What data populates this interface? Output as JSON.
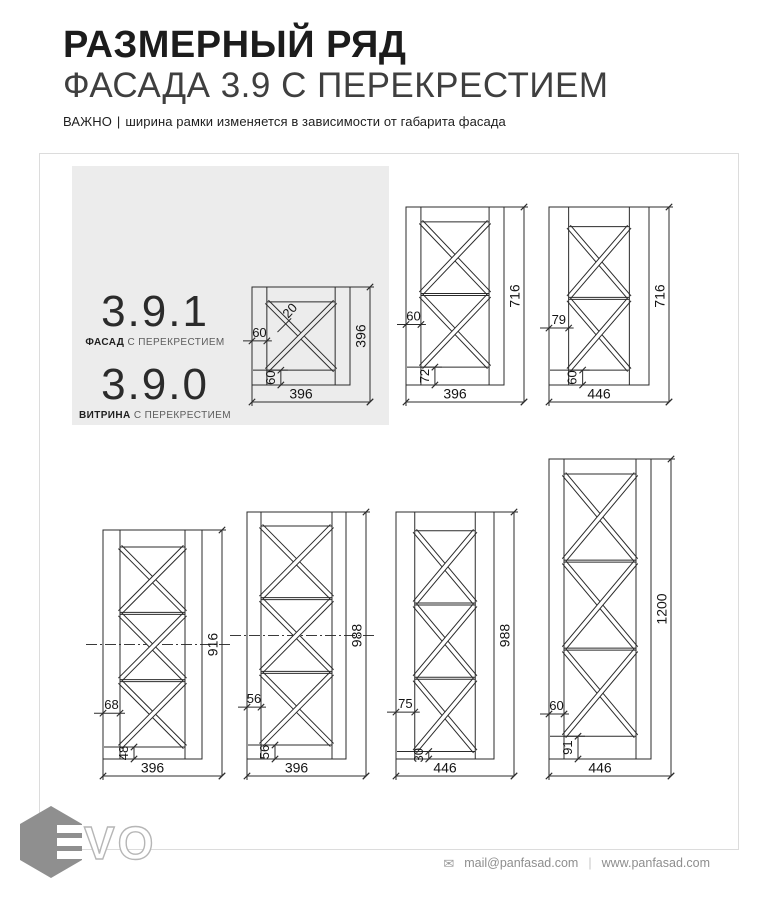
{
  "header": {
    "title": "РАЗМЕРНЫЙ РЯД",
    "subtitle": "ФАСАДА 3.9 С ПЕРЕКРЕСТИЕМ",
    "note_prefix": "ВАЖНО",
    "note_separator": "|",
    "note_text": "ширина рамки изменяется в зависимости от габарита фасада"
  },
  "legend": {
    "items": [
      {
        "code": "3.9.1",
        "type": "ФАСАД",
        "suffix": " С ПЕРЕКРЕСТИЕМ"
      },
      {
        "code": "3.9.0",
        "type": "ВИТРИНА",
        "suffix": " С ПЕРЕКРЕСТИЕМ"
      }
    ]
  },
  "drawings": [
    {
      "name": "facade-396x396",
      "width_label": "396",
      "height_label": "396",
      "left_dim_label": "60",
      "bottom_dim_label": "60",
      "cross_label": "20",
      "width_mm": 396,
      "height_mm": 396,
      "frame_side_mm": 60,
      "bottom_rail_mm": 60,
      "cross_mm": 20,
      "panels": 1,
      "centerline": false
    },
    {
      "name": "facade-396x716",
      "width_label": "396",
      "height_label": "716",
      "left_dim_label": "60",
      "bottom_dim_label": "72",
      "width_mm": 396,
      "height_mm": 716,
      "frame_side_mm": 60,
      "bottom_rail_mm": 72,
      "cross_mm": 20,
      "panels": 2,
      "centerline": false
    },
    {
      "name": "facade-446x716",
      "width_label": "446",
      "height_label": "716",
      "left_dim_label": "79",
      "bottom_dim_label": "60",
      "width_mm": 446,
      "height_mm": 716,
      "frame_side_mm": 79,
      "bottom_rail_mm": 60,
      "cross_mm": 20,
      "panels": 2,
      "centerline": false
    },
    {
      "name": "facade-396x916",
      "width_label": "396",
      "height_label": "916",
      "left_dim_label": "68",
      "bottom_dim_label": "48",
      "width_mm": 396,
      "height_mm": 916,
      "frame_side_mm": 68,
      "bottom_rail_mm": 48,
      "cross_mm": 20,
      "panels": 3,
      "centerline": true
    },
    {
      "name": "facade-396x988",
      "width_label": "396",
      "height_label": "988",
      "left_dim_label": "56",
      "bottom_dim_label": "56",
      "width_mm": 396,
      "height_mm": 988,
      "frame_side_mm": 56,
      "bottom_rail_mm": 56,
      "cross_mm": 20,
      "panels": 3,
      "centerline": true
    },
    {
      "name": "facade-446x988",
      "width_label": "446",
      "height_label": "988",
      "left_dim_label": "75",
      "bottom_dim_label": "30",
      "width_mm": 446,
      "height_mm": 988,
      "frame_side_mm": 75,
      "bottom_rail_mm": 30,
      "cross_mm": 20,
      "panels": 3,
      "centerline": false
    },
    {
      "name": "facade-446x1200",
      "width_label": "446",
      "height_label": "1200",
      "left_dim_label": "60",
      "bottom_dim_label": "91",
      "width_mm": 446,
      "height_mm": 1200,
      "frame_side_mm": 60,
      "bottom_rail_mm": 91,
      "cross_mm": 20,
      "panels": 3,
      "centerline": false
    }
  ],
  "footer": {
    "logo_vo": "VO",
    "envelope_icon": "✉",
    "email": "mail@panfasad.com",
    "separator": "|",
    "website": "www.panfasad.com"
  },
  "colors": {
    "line": "#2b2b2b",
    "panel_bg": "#ececec",
    "border": "#dcdcdc",
    "footer_text": "#8e8e8e",
    "logo_gray": "#8f8f8f"
  }
}
